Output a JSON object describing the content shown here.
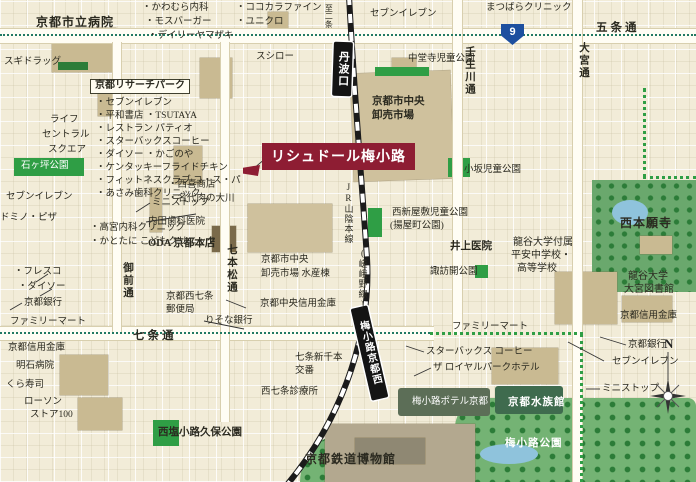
{
  "title": {
    "text": "リシュドール梅小路"
  },
  "route_shield": {
    "number": "9"
  },
  "compass": {
    "north": "N"
  },
  "stations": {
    "tambaguchi": "丹波口",
    "umekoji_kyotonishi": "梅小路京都西"
  },
  "colors": {
    "background": "#f2ecd8",
    "building": "#c9ba92",
    "park_small": "#2f9e45",
    "park_large": "#74b374",
    "water": "#8fc3dc",
    "title_bg": "#8e1d33",
    "station_bg": "#141414",
    "route_blue": "#1d4f9f",
    "dotted_teal": "#227a63"
  },
  "labels": [
    {
      "t": "京都市立病院",
      "x": 36,
      "y": 16,
      "c": "b"
    },
    {
      "t": "・かわむら内科",
      "x": 142,
      "y": 4,
      "c": "s"
    },
    {
      "t": "・モスバーガー",
      "x": 145,
      "y": 18,
      "c": "s"
    },
    {
      "t": "・デイリーヤマザキ",
      "x": 148,
      "y": 32,
      "c": "s"
    },
    {
      "t": "・ココカラファイン",
      "x": 236,
      "y": 4,
      "c": "s"
    },
    {
      "t": "・ユニクロ",
      "x": 236,
      "y": 18,
      "c": "s"
    },
    {
      "t": "セブンイレブン",
      "x": 370,
      "y": 10,
      "c": "s"
    },
    {
      "t": "まつばらクリニック",
      "x": 486,
      "y": 4,
      "c": "s"
    },
    {
      "t": "五条通",
      "x": 596,
      "y": 22,
      "c": "road"
    },
    {
      "t": "スシロー",
      "x": 256,
      "y": 53,
      "c": "s"
    },
    {
      "t": "中堂寺児童公園",
      "x": 408,
      "y": 55,
      "c": "s"
    },
    {
      "t": "京都リサーチパーク",
      "x": 90,
      "y": 79,
      "c": "boxed"
    },
    {
      "t": "・セブンイレブン",
      "x": 96,
      "y": 99,
      "c": "s"
    },
    {
      "t": "・平和書店 ・TSUTAYA",
      "x": 96,
      "y": 112,
      "c": "s"
    },
    {
      "t": "・レストラン パティオ",
      "x": 96,
      "y": 125,
      "c": "s"
    },
    {
      "t": "・スターバックスコーヒー",
      "x": 96,
      "y": 138,
      "c": "s"
    },
    {
      "t": "・ダイソー ・かごのや",
      "x": 96,
      "y": 151,
      "c": "s"
    },
    {
      "t": "・ケンタッキーフライドチキン",
      "x": 96,
      "y": 164,
      "c": "s"
    },
    {
      "t": "・フィットネスクラブ コ・ス・パ",
      "x": 96,
      "y": 177,
      "c": "s"
    },
    {
      "t": "・あさみ歯科クリニック",
      "x": 96,
      "y": 190,
      "c": "s"
    },
    {
      "t": "スギドラッグ",
      "x": 4,
      "y": 58,
      "c": "s"
    },
    {
      "t": "ライフ",
      "x": 50,
      "y": 116,
      "c": "s"
    },
    {
      "t": "セントラル",
      "x": 42,
      "y": 131,
      "c": "s"
    },
    {
      "t": "スクエア",
      "x": 48,
      "y": 146,
      "c": "s"
    },
    {
      "t": "石ヶ坪公園",
      "x": 21,
      "y": 162,
      "c": "sw"
    },
    {
      "t": "セブンイレブン",
      "x": 6,
      "y": 193,
      "c": "s"
    },
    {
      "t": "ドミノ・ピザ",
      "x": 0,
      "y": 214,
      "c": "s"
    },
    {
      "t": "・高宮内科クリニック",
      "x": 90,
      "y": 224,
      "c": "s"
    },
    {
      "t": "・かとたに こどもクリニック",
      "x": 90,
      "y": 238,
      "c": "s"
    },
    {
      "t": "・フレスコ",
      "x": 14,
      "y": 268,
      "c": "s"
    },
    {
      "t": "・ダイソー",
      "x": 18,
      "y": 283,
      "c": "s"
    },
    {
      "t": "京都銀行",
      "x": 24,
      "y": 299,
      "c": "s"
    },
    {
      "t": "ファミリーマート",
      "x": 10,
      "y": 318,
      "c": "s"
    },
    {
      "t": "ミニストップ",
      "x": 152,
      "y": 199,
      "c": "s"
    },
    {
      "t": "・西喜商店",
      "x": 168,
      "y": 181,
      "c": "s"
    },
    {
      "t": "・名代肉の大川",
      "x": 168,
      "y": 195,
      "c": "s"
    },
    {
      "t": "内田歯科医院",
      "x": 148,
      "y": 218,
      "c": "s"
    },
    {
      "t": "ODA 京都本店",
      "x": 148,
      "y": 238,
      "c": "b2"
    },
    {
      "t": "京都市中央",
      "x": 372,
      "y": 96,
      "c": "b2"
    },
    {
      "t": "卸売市場",
      "x": 372,
      "y": 110,
      "c": "b2"
    },
    {
      "t": "京都市中央",
      "x": 261,
      "y": 256,
      "c": "s"
    },
    {
      "t": "卸売市場 水産棟",
      "x": 261,
      "y": 270,
      "c": "s"
    },
    {
      "t": "京都中央信用金庫",
      "x": 260,
      "y": 300,
      "c": "s"
    },
    {
      "t": "京都西七条",
      "x": 166,
      "y": 293,
      "c": "s"
    },
    {
      "t": "郵便局",
      "x": 166,
      "y": 306,
      "c": "s"
    },
    {
      "t": "りそな銀行",
      "x": 205,
      "y": 317,
      "c": "s"
    },
    {
      "t": "七条通",
      "x": 133,
      "y": 330,
      "c": "road"
    },
    {
      "t": "京都信用金庫",
      "x": 8,
      "y": 344,
      "c": "s"
    },
    {
      "t": "明石病院",
      "x": 16,
      "y": 362,
      "c": "s"
    },
    {
      "t": "くら寿司",
      "x": 6,
      "y": 381,
      "c": "s"
    },
    {
      "t": "ローソン",
      "x": 24,
      "y": 398,
      "c": "s"
    },
    {
      "t": "ストア100",
      "x": 30,
      "y": 411,
      "c": "s"
    },
    {
      "t": "西塩小路久保公園",
      "x": 158,
      "y": 427,
      "c": "b2"
    },
    {
      "t": "七条新千本",
      "x": 295,
      "y": 354,
      "c": "s"
    },
    {
      "t": "交番",
      "x": 295,
      "y": 367,
      "c": "s"
    },
    {
      "t": "西七条診療所",
      "x": 261,
      "y": 388,
      "c": "s"
    },
    {
      "t": "京都鉄道博物館",
      "x": 305,
      "y": 453,
      "c": "b"
    },
    {
      "t": "スターバックス コーヒー",
      "x": 426,
      "y": 348,
      "c": "s"
    },
    {
      "t": "ザ ロイヤルパークホテル",
      "x": 433,
      "y": 364,
      "c": "s"
    },
    {
      "t": "梅小路ポテル京都",
      "x": 412,
      "y": 398,
      "c": "sw"
    },
    {
      "t": "京都水族館",
      "x": 508,
      "y": 397,
      "c": "bw"
    },
    {
      "t": "梅小路公園",
      "x": 505,
      "y": 438,
      "c": "bw"
    },
    {
      "t": "ファミリーマート",
      "x": 452,
      "y": 323,
      "c": "s"
    },
    {
      "t": "西新屋敷児童公園",
      "x": 392,
      "y": 209,
      "c": "s"
    },
    {
      "t": "(揚屋町公園)",
      "x": 390,
      "y": 222,
      "c": "s"
    },
    {
      "t": "井上医院",
      "x": 450,
      "y": 241,
      "c": "b2"
    },
    {
      "t": "諏訪開公園",
      "x": 430,
      "y": 268,
      "c": "s"
    },
    {
      "t": "小坂児童公園",
      "x": 464,
      "y": 166,
      "c": "s"
    },
    {
      "t": "西本願寺",
      "x": 620,
      "y": 217,
      "c": "b"
    },
    {
      "t": "龍谷大学付属",
      "x": 513,
      "y": 238,
      "c": "s2"
    },
    {
      "t": "平安中学校・",
      "x": 511,
      "y": 251,
      "c": "s2"
    },
    {
      "t": "高等学校",
      "x": 517,
      "y": 264,
      "c": "s2"
    },
    {
      "t": "龍谷大学",
      "x": 628,
      "y": 272,
      "c": "s2"
    },
    {
      "t": "大宮図書館",
      "x": 624,
      "y": 285,
      "c": "s2"
    },
    {
      "t": "京都信用金庫",
      "x": 620,
      "y": 312,
      "c": "s"
    },
    {
      "t": "京都銀行",
      "x": 628,
      "y": 341,
      "c": "s"
    },
    {
      "t": "セブンイレブン",
      "x": 612,
      "y": 358,
      "c": "s"
    },
    {
      "t": "ミニストップ",
      "x": 602,
      "y": 385,
      "c": "s"
    },
    {
      "t": "壬生川通",
      "x": 464,
      "y": 46,
      "c": "vroad"
    },
    {
      "t": "大宮通",
      "x": 578,
      "y": 42,
      "c": "vroad"
    },
    {
      "t": "御前通",
      "x": 122,
      "y": 262,
      "c": "vroad"
    },
    {
      "t": "七本松通",
      "x": 226,
      "y": 244,
      "c": "vroad"
    },
    {
      "t": "JR山陰本線",
      "x": 343,
      "y": 182,
      "c": "vline"
    },
    {
      "t": "(嵯峨野線)",
      "x": 357,
      "y": 248,
      "c": "vline"
    },
    {
      "t": "至二条",
      "x": 324,
      "y": 4,
      "c": "vtiny"
    }
  ]
}
